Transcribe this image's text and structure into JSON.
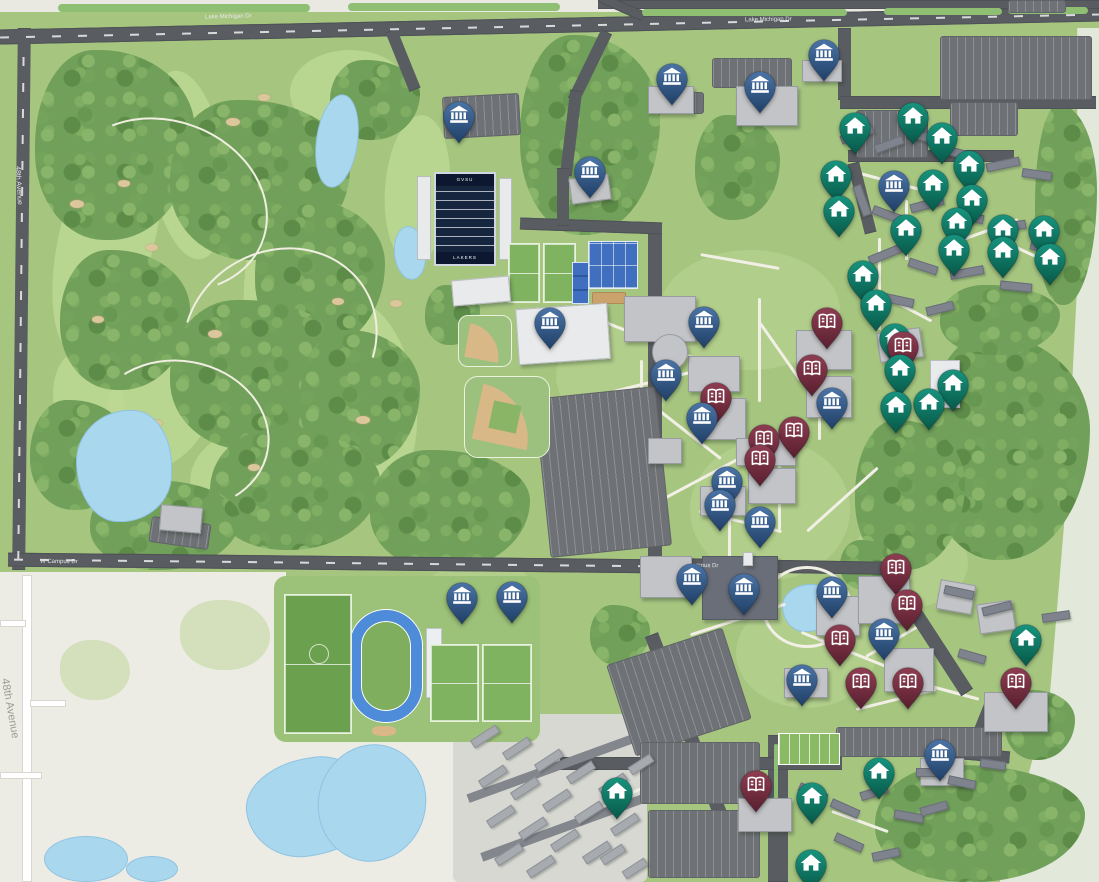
{
  "map": {
    "type": "university-campus-map",
    "palette": {
      "campus_green": "#a6c680",
      "forest_green": "#71a05a",
      "water_blue": "#a9d7ee",
      "road_gray": "#595c61",
      "offcampus_beige": "#edece4",
      "path_white": "#f2f0e6",
      "building_gray": "#c3c4c7",
      "track_blue": "#4e8bd8",
      "football_field_navy": "#17263f"
    },
    "stadium": {
      "endzone_top": "GVSU",
      "endzone_bottom": "LAKERS"
    },
    "road_labels": [
      {
        "text": "Lake Michigan Dr",
        "x": 205,
        "y": 14,
        "rot": -1.5,
        "size": 6,
        "color": "#e8e8e8"
      },
      {
        "text": "Lake Michigan Dr",
        "x": 745,
        "y": 17,
        "rot": -1,
        "size": 6,
        "color": "#e8e8e8"
      },
      {
        "text": "48th Avenue",
        "x": -1,
        "y": 182,
        "rot": 87,
        "size": 7,
        "color": "#e8e8e8"
      },
      {
        "text": "W Campus Dr",
        "x": 40,
        "y": 559,
        "rot": 0.5,
        "size": 6,
        "color": "#e8e8e8"
      },
      {
        "text": "Campus Dr",
        "x": 688,
        "y": 563,
        "rot": 1,
        "size": 6,
        "color": "#e8e8e8"
      },
      {
        "text": "48th Avenue",
        "x": -21,
        "y": 703,
        "rot": 80,
        "size": 11,
        "color": "#9b9b94"
      }
    ],
    "pins": {
      "categories": [
        {
          "id": "academic",
          "icon": "bank-icon",
          "color": "#2f5585",
          "color_top": "#4b74a6",
          "color_bottom": "#1f3f66"
        },
        {
          "id": "housing",
          "icon": "house-icon",
          "color": "#0f8673",
          "color_top": "#18947e",
          "color_bottom": "#075848"
        },
        {
          "id": "books",
          "icon": "book-icon",
          "color": "#7c2f42",
          "color_top": "#8f3d52",
          "color_bottom": "#571f2e"
        }
      ],
      "items": [
        {
          "type": "academic",
          "x": 459,
          "y": 117
        },
        {
          "type": "academic",
          "x": 590,
          "y": 172
        },
        {
          "type": "academic",
          "x": 672,
          "y": 79
        },
        {
          "type": "academic",
          "x": 760,
          "y": 87
        },
        {
          "type": "academic",
          "x": 824,
          "y": 55
        },
        {
          "type": "academic",
          "x": 894,
          "y": 186
        },
        {
          "type": "academic",
          "x": 550,
          "y": 323
        },
        {
          "type": "academic",
          "x": 704,
          "y": 322
        },
        {
          "type": "academic",
          "x": 666,
          "y": 375
        },
        {
          "type": "academic",
          "x": 702,
          "y": 418
        },
        {
          "type": "academic",
          "x": 727,
          "y": 482
        },
        {
          "type": "academic",
          "x": 720,
          "y": 505
        },
        {
          "type": "academic",
          "x": 760,
          "y": 522
        },
        {
          "type": "academic",
          "x": 832,
          "y": 403
        },
        {
          "type": "academic",
          "x": 692,
          "y": 579
        },
        {
          "type": "academic",
          "x": 744,
          "y": 589
        },
        {
          "type": "academic",
          "x": 832,
          "y": 592
        },
        {
          "type": "academic",
          "x": 884,
          "y": 634
        },
        {
          "type": "academic",
          "x": 462,
          "y": 598
        },
        {
          "type": "academic",
          "x": 512,
          "y": 597
        },
        {
          "type": "academic",
          "x": 802,
          "y": 680
        },
        {
          "type": "academic",
          "x": 940,
          "y": 755
        },
        {
          "type": "housing",
          "x": 855,
          "y": 128
        },
        {
          "type": "housing",
          "x": 913,
          "y": 118
        },
        {
          "type": "housing",
          "x": 942,
          "y": 138
        },
        {
          "type": "housing",
          "x": 969,
          "y": 166
        },
        {
          "type": "housing",
          "x": 836,
          "y": 176
        },
        {
          "type": "housing",
          "x": 933,
          "y": 185
        },
        {
          "type": "housing",
          "x": 972,
          "y": 200
        },
        {
          "type": "housing",
          "x": 839,
          "y": 211
        },
        {
          "type": "housing",
          "x": 906,
          "y": 230
        },
        {
          "type": "housing",
          "x": 957,
          "y": 223
        },
        {
          "type": "housing",
          "x": 1003,
          "y": 230
        },
        {
          "type": "housing",
          "x": 1044,
          "y": 231
        },
        {
          "type": "housing",
          "x": 954,
          "y": 250
        },
        {
          "type": "housing",
          "x": 1003,
          "y": 252
        },
        {
          "type": "housing",
          "x": 1050,
          "y": 259
        },
        {
          "type": "housing",
          "x": 863,
          "y": 276
        },
        {
          "type": "housing",
          "x": 876,
          "y": 305
        },
        {
          "type": "housing",
          "x": 895,
          "y": 339
        },
        {
          "type": "housing",
          "x": 900,
          "y": 370
        },
        {
          "type": "housing",
          "x": 896,
          "y": 407
        },
        {
          "type": "housing",
          "x": 929,
          "y": 404
        },
        {
          "type": "housing",
          "x": 953,
          "y": 385
        },
        {
          "type": "housing",
          "x": 1026,
          "y": 640
        },
        {
          "type": "housing",
          "x": 617,
          "y": 793
        },
        {
          "type": "housing",
          "x": 812,
          "y": 798
        },
        {
          "type": "housing",
          "x": 811,
          "y": 865
        },
        {
          "type": "housing",
          "x": 879,
          "y": 773
        },
        {
          "type": "books",
          "x": 827,
          "y": 323
        },
        {
          "type": "books",
          "x": 812,
          "y": 370
        },
        {
          "type": "books",
          "x": 716,
          "y": 398
        },
        {
          "type": "books",
          "x": 764,
          "y": 440
        },
        {
          "type": "books",
          "x": 794,
          "y": 432
        },
        {
          "type": "books",
          "x": 760,
          "y": 460
        },
        {
          "type": "books",
          "x": 903,
          "y": 347
        },
        {
          "type": "books",
          "x": 896,
          "y": 569
        },
        {
          "type": "books",
          "x": 907,
          "y": 605
        },
        {
          "type": "books",
          "x": 840,
          "y": 640
        },
        {
          "type": "books",
          "x": 861,
          "y": 683
        },
        {
          "type": "books",
          "x": 908,
          "y": 683
        },
        {
          "type": "books",
          "x": 1016,
          "y": 683
        },
        {
          "type": "books",
          "x": 756,
          "y": 786
        }
      ]
    }
  }
}
